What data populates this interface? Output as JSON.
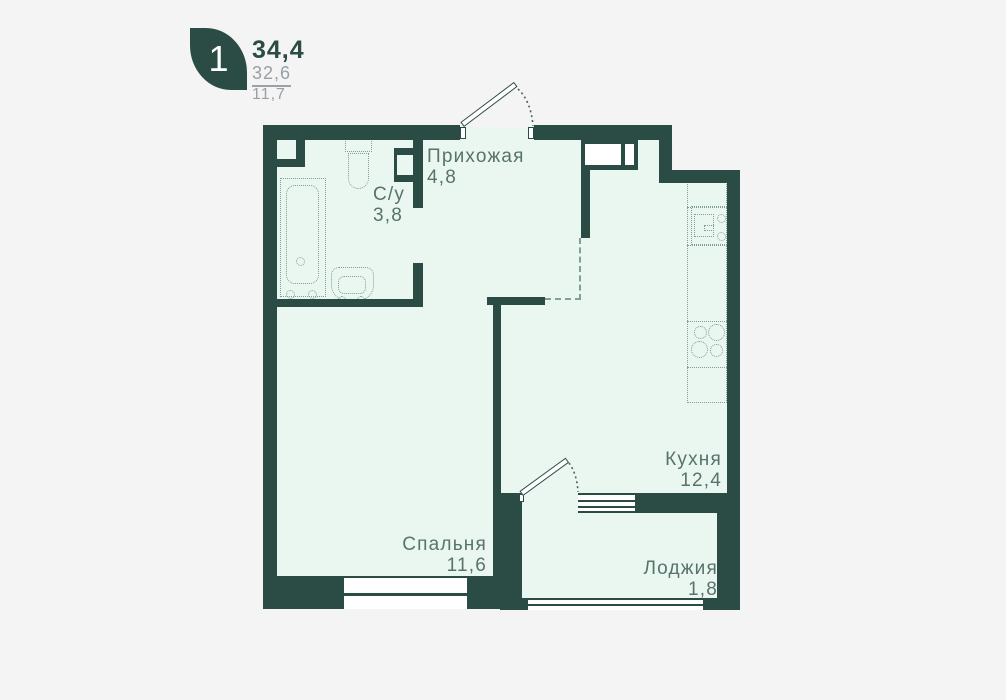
{
  "unit_card": {
    "rooms_badge": "1",
    "total_area": "34,4",
    "living_area": "32,6",
    "kitchen_area": "11,7"
  },
  "rooms": [
    {
      "id": "hallway",
      "name": "Прихожая",
      "area": "4,8"
    },
    {
      "id": "bathroom",
      "name": "С/у",
      "area": "3,8"
    },
    {
      "id": "kitchen",
      "name": "Кухня",
      "area": "12,4"
    },
    {
      "id": "bedroom",
      "name": "Спальня",
      "area": "11,6"
    },
    {
      "id": "loggia",
      "name": "Лоджия",
      "area": "1,8"
    }
  ],
  "colors": {
    "wall": "#2b4c44",
    "floor": "#eaf7f1",
    "background": "#f5f4f5",
    "label_text": "#57736c",
    "fixture_dotted": "#7f9e94",
    "secondary_text": "#97a0a5",
    "badge": "#2b4c44"
  },
  "icons": [
    "leaf-badge-icon",
    "bathtub-icon",
    "toilet-icon",
    "sink-icon",
    "duct-icon",
    "shaft-icon",
    "wardrobe-icon",
    "kitchen-counter-icon",
    "kitchen-sink-icon",
    "stove-icon",
    "entry-door-icon",
    "loggia-door-icon",
    "window-icon"
  ]
}
